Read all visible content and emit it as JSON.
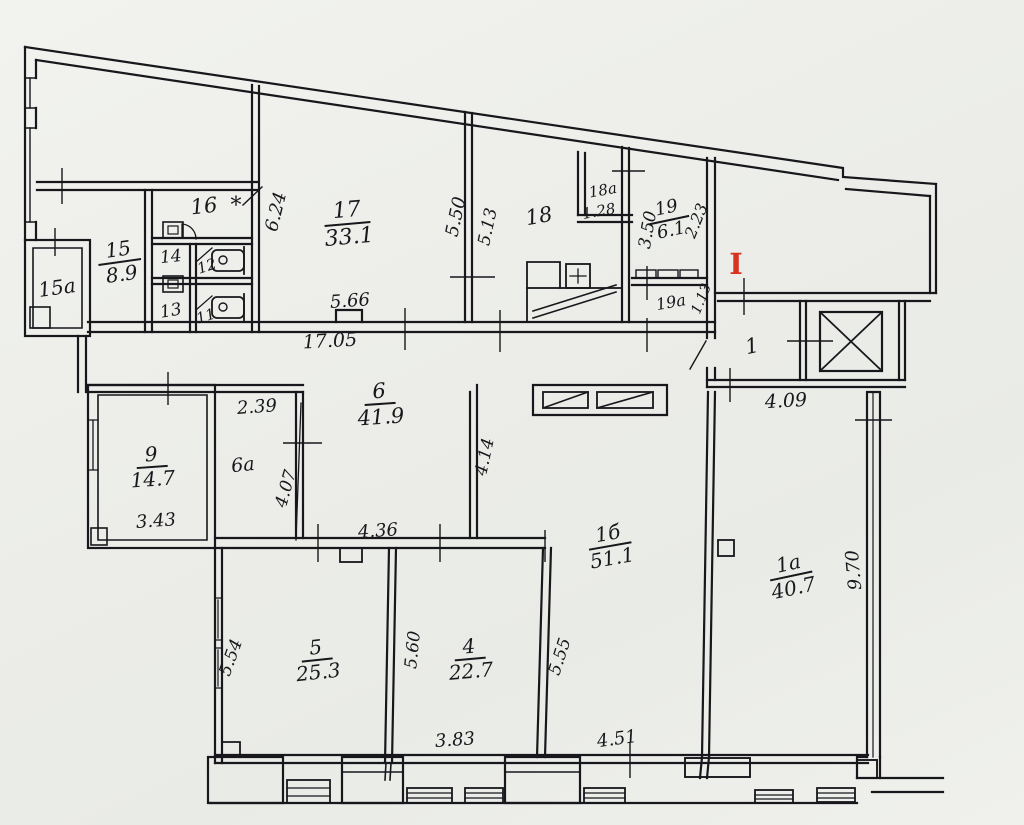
{
  "document": {
    "kind_label": "floor plan drawing"
  },
  "colors": {
    "paper": "#eceee9",
    "ink": "#17171c",
    "section_mark_red": "#d8321f"
  },
  "marks": {
    "section_mark": "I",
    "room16_note": "*"
  },
  "rooms": {
    "r15a": {
      "number": "15а"
    },
    "r15": {
      "number": "15",
      "area": "8.9"
    },
    "r16": {
      "number": "16"
    },
    "r14": {
      "number": "14"
    },
    "r13": {
      "number": "13"
    },
    "r12": {
      "number": "12"
    },
    "r11": {
      "number": "11"
    },
    "r17": {
      "number": "17",
      "area": "33.1"
    },
    "r18": {
      "number": "18"
    },
    "r18a": {
      "number": "18а",
      "area": "1.28"
    },
    "r19": {
      "number": "19",
      "area": "6.1"
    },
    "r19a": {
      "number": "19а",
      "area": "1.13"
    },
    "r1": {
      "number": "1"
    },
    "r9": {
      "number": "9",
      "area": "14.7"
    },
    "r6": {
      "number": "6",
      "area": "41.9"
    },
    "r6a": {
      "number": "6а"
    },
    "r1b": {
      "number": "1б",
      "area": "51.1"
    },
    "r1a": {
      "number": "1а",
      "area": "40.7"
    },
    "r5": {
      "number": "5",
      "area": "25.3"
    },
    "r4": {
      "number": "4",
      "area": "22.7"
    }
  },
  "dims": {
    "room17_height": "6.24",
    "room17_inner_width": "5.66",
    "corridor_total_width": "17.05",
    "room18_left_height": "5.50",
    "room18_left_height2": "5.13",
    "room19_height": "3.50",
    "room19_right_height": "2.23",
    "room1_width": "4.09",
    "room6a_width": "2.39",
    "room6a_height": "4.07",
    "room9_width": "3.43",
    "hall6_bottom_width": "4.36",
    "hall6_right_height": "4.14",
    "room1a_height": "9.70",
    "room5_left_height": "5.54",
    "room5_right_height": "5.60",
    "room4_right_height": "5.55",
    "room4_bottom_width": "3.83",
    "room1b_bottom_width": "4.51"
  }
}
